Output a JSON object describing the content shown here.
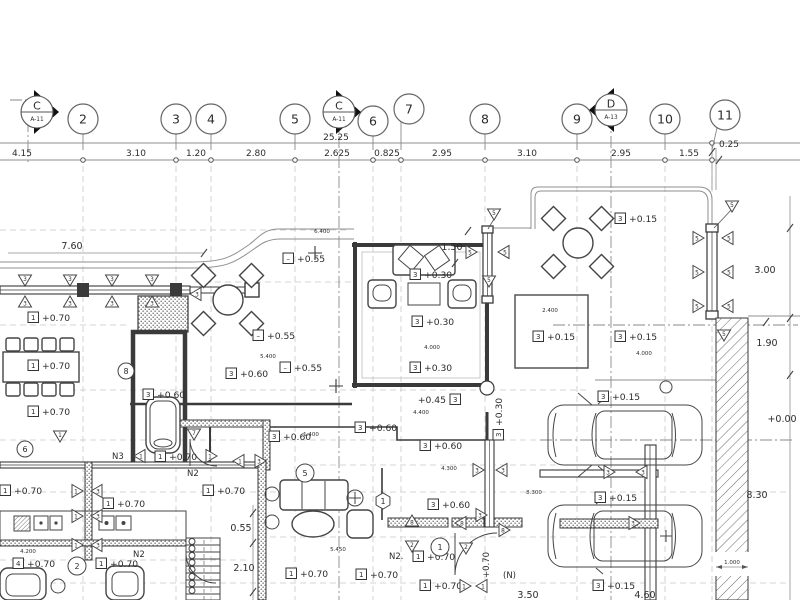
{
  "grid": {
    "bubbles": [
      {
        "n": "2",
        "x": 83,
        "y": 119,
        "gx": 83
      },
      {
        "n": "3",
        "x": 176,
        "y": 119,
        "gx": 176
      },
      {
        "n": "4",
        "x": 211,
        "y": 119,
        "gx": 211
      },
      {
        "n": "5",
        "x": 295,
        "y": 119,
        "gx": 295
      },
      {
        "n": "6",
        "x": 373,
        "y": 121,
        "gx": 373
      },
      {
        "n": "7",
        "x": 409,
        "y": 109,
        "gx": 401
      },
      {
        "n": "8",
        "x": 485,
        "y": 119,
        "gx": 485
      },
      {
        "n": "9",
        "x": 577,
        "y": 119,
        "gx": 577
      },
      {
        "n": "10",
        "x": 665,
        "y": 119,
        "gx": 665
      },
      {
        "n": "11",
        "x": 725,
        "y": 115,
        "gx": 712
      }
    ],
    "sections": [
      {
        "letter": "C",
        "sheet": "A-11",
        "x": 37,
        "y": 112,
        "dir": "right"
      },
      {
        "letter": "C",
        "sheet": "A-11",
        "x": 339,
        "y": 112,
        "dir": "right"
      },
      {
        "letter": "D",
        "sheet": "A-13",
        "x": 611,
        "y": 110,
        "dir": "left"
      }
    ],
    "total_dim": {
      "t": "25.25",
      "x": 336,
      "y": 140
    },
    "top_dims": [
      {
        "t": "4.15",
        "x": 22
      },
      {
        "t": "3.10",
        "x": 136
      },
      {
        "t": "1.20",
        "x": 196
      },
      {
        "t": "2.80",
        "x": 256
      },
      {
        "t": "2.625",
        "x": 337
      },
      {
        "t": "0.825",
        "x": 387
      },
      {
        "t": "2.95",
        "x": 442
      },
      {
        "t": "3.10",
        "x": 527
      },
      {
        "t": "2.95",
        "x": 621
      },
      {
        "t": "1.55",
        "x": 689
      },
      {
        "t": "0.25",
        "x": 729,
        "y": 147
      }
    ],
    "ticks": [
      83,
      176,
      211,
      295,
      373,
      401,
      485,
      577,
      665,
      712
    ]
  },
  "dims": [
    {
      "t": "7.60",
      "x": 72,
      "y": 249
    },
    {
      "t": "1.50",
      "x": 452,
      "y": 250
    },
    {
      "t": "3.00",
      "x": 765,
      "y": 273
    },
    {
      "t": "1.90",
      "x": 767,
      "y": 346
    },
    {
      "t": "+0.00",
      "x": 782,
      "y": 422
    },
    {
      "t": "8.30",
      "x": 757,
      "y": 498
    },
    {
      "t": "0.55",
      "x": 241,
      "y": 531
    },
    {
      "t": "2.10",
      "x": 244,
      "y": 571
    },
    {
      "t": "3.50",
      "x": 528,
      "y": 598
    },
    {
      "t": "4.60",
      "x": 645,
      "y": 598
    },
    {
      "t": "6.400",
      "x": 322,
      "y": 233,
      "fs": 5.5
    },
    {
      "t": "5.400",
      "x": 268,
      "y": 358,
      "fs": 5.5
    },
    {
      "t": "4.000",
      "x": 432,
      "y": 349,
      "fs": 5.5
    },
    {
      "t": "4.400",
      "x": 421,
      "y": 414,
      "fs": 5.5
    },
    {
      "t": "4.300",
      "x": 449,
      "y": 470,
      "fs": 5.5
    },
    {
      "t": "2.400",
      "x": 550,
      "y": 312,
      "fs": 5.5
    },
    {
      "t": "4.000",
      "x": 644,
      "y": 355,
      "fs": 5.5
    },
    {
      "t": "5.450",
      "x": 338,
      "y": 551,
      "fs": 5.5
    },
    {
      "t": "4.200",
      "x": 28,
      "y": 553,
      "fs": 5.5
    },
    {
      "t": "8.300",
      "x": 534,
      "y": 494,
      "fs": 5.5
    },
    {
      "t": "1.000",
      "x": 732,
      "y": 564,
      "fs": 5.5
    },
    {
      "t": "1.400",
      "x": 311,
      "y": 436,
      "fs": 5.5
    }
  ],
  "levels": [
    {
      "b": "1",
      "t": "+0.70",
      "x": 28,
      "y": 321
    },
    {
      "b": "1",
      "t": "+0.70",
      "x": 28,
      "y": 369
    },
    {
      "b": "1",
      "t": "+0.70",
      "x": 28,
      "y": 415
    },
    {
      "b": "1",
      "t": "+0.70",
      "x": 0,
      "y": 494
    },
    {
      "b": "1",
      "t": "+0.70",
      "x": 103,
      "y": 507
    },
    {
      "b": "1",
      "t": "+0.70",
      "x": 155,
      "y": 460
    },
    {
      "b": "1",
      "t": "+0.70",
      "x": 203,
      "y": 494
    },
    {
      "b": "4",
      "t": "+0.70",
      "x": 13,
      "y": 567
    },
    {
      "b": "1",
      "t": "+0.70",
      "x": 96,
      "y": 567
    },
    {
      "b": "1",
      "t": "+0.70",
      "x": 286,
      "y": 577
    },
    {
      "b": "1",
      "t": "+0.70",
      "x": 356,
      "y": 578
    },
    {
      "b": "1",
      "t": "+0.70",
      "x": 413,
      "y": 560
    },
    {
      "b": "1",
      "t": "+0.70",
      "x": 420,
      "y": 589
    },
    {
      "b": "3",
      "t": "+0.60",
      "x": 226,
      "y": 377
    },
    {
      "b": "3",
      "t": "+0.60",
      "x": 143,
      "y": 398
    },
    {
      "b": "3",
      "t": "+0.60",
      "x": 269,
      "y": 440
    },
    {
      "b": "3",
      "t": "+0.60",
      "x": 355,
      "y": 431
    },
    {
      "b": "3",
      "t": "+0.60",
      "x": 420,
      "y": 449
    },
    {
      "b": "3",
      "t": "+0.60",
      "x": 428,
      "y": 508
    },
    {
      "b": "3",
      "t": "+0.30",
      "x": 410,
      "y": 278
    },
    {
      "b": "3",
      "t": "+0.30",
      "x": 412,
      "y": 325
    },
    {
      "b": "3",
      "t": "+0.30",
      "x": 410,
      "y": 371
    },
    {
      "b": "3",
      "t": "+0.45",
      "x": 450,
      "y": 403,
      "flip": true
    },
    {
      "b": "3",
      "t": "+0.30",
      "x": 502,
      "y": 440,
      "rot": -90
    },
    {
      "b": "3",
      "t": "+0.15",
      "x": 615,
      "y": 222
    },
    {
      "b": "3",
      "t": "+0.15",
      "x": 533,
      "y": 340
    },
    {
      "b": "3",
      "t": "+0.15",
      "x": 615,
      "y": 340
    },
    {
      "b": "3",
      "t": "+0.15",
      "x": 598,
      "y": 400
    },
    {
      "b": "3",
      "t": "+0.15",
      "x": 595,
      "y": 501
    },
    {
      "b": "3",
      "t": "+0.15",
      "x": 593,
      "y": 589
    },
    {
      "b": "–",
      "t": "+0.55",
      "x": 283,
      "y": 262
    },
    {
      "b": "–",
      "t": "+0.55",
      "x": 253,
      "y": 339
    },
    {
      "b": "–",
      "t": "+0.55",
      "x": 280,
      "y": 371
    }
  ],
  "tags": {
    "circles": [
      {
        "t": "8",
        "x": 126,
        "y": 371,
        "r": 8
      },
      {
        "t": "6",
        "x": 25,
        "y": 449,
        "r": 8
      },
      {
        "t": "2",
        "x": 77,
        "y": 566,
        "r": 9
      },
      {
        "t": "5",
        "x": 305,
        "y": 473,
        "r": 9
      },
      {
        "t": "1",
        "x": 440,
        "y": 547,
        "r": 9
      }
    ],
    "hexes": [
      {
        "t": "1",
        "x": 383,
        "y": 501,
        "r": 8
      }
    ],
    "texts": [
      {
        "t": "N3",
        "x": 112,
        "y": 459
      },
      {
        "t": "N2",
        "x": 187,
        "y": 476
      },
      {
        "t": "N2",
        "x": 133,
        "y": 557
      },
      {
        "t": "N2.",
        "x": 389,
        "y": 559
      },
      {
        "t": "(N)",
        "x": 503,
        "y": 578
      },
      {
        "t": "+0.70",
        "x": 489,
        "y": 578,
        "rot": -90
      }
    ]
  },
  "markers": [
    {
      "t": "3",
      "x": 25,
      "y": 280,
      "d": "dn"
    },
    {
      "t": "3",
      "x": 25,
      "y": 302,
      "d": "up"
    },
    {
      "t": "3",
      "x": 70,
      "y": 280,
      "d": "dn"
    },
    {
      "t": "3",
      "x": 70,
      "y": 302,
      "d": "up"
    },
    {
      "t": "3",
      "x": 112,
      "y": 280,
      "d": "dn"
    },
    {
      "t": "3",
      "x": 112,
      "y": 302,
      "d": "up"
    },
    {
      "t": "3",
      "x": 152,
      "y": 280,
      "d": "dn"
    },
    {
      "t": "3",
      "x": 152,
      "y": 302,
      "d": "up"
    },
    {
      "t": "3",
      "x": 196,
      "y": 294,
      "d": "lf"
    },
    {
      "t": "5",
      "x": 471,
      "y": 252,
      "d": "rt"
    },
    {
      "t": "5",
      "x": 504,
      "y": 252,
      "d": "lf"
    },
    {
      "t": "5",
      "x": 489,
      "y": 281,
      "d": "dn"
    },
    {
      "t": "5",
      "x": 494,
      "y": 214,
      "d": "dn"
    },
    {
      "t": "5",
      "x": 698,
      "y": 238,
      "d": "rt"
    },
    {
      "t": "5",
      "x": 728,
      "y": 238,
      "d": "lf"
    },
    {
      "t": "5",
      "x": 698,
      "y": 272,
      "d": "rt"
    },
    {
      "t": "5",
      "x": 728,
      "y": 272,
      "d": "lf"
    },
    {
      "t": "5",
      "x": 698,
      "y": 306,
      "d": "rt"
    },
    {
      "t": "5",
      "x": 728,
      "y": 306,
      "d": "lf"
    },
    {
      "t": "5",
      "x": 732,
      "y": 206,
      "d": "dn"
    },
    {
      "t": "5",
      "x": 724,
      "y": 335,
      "d": "dn"
    },
    {
      "t": "1",
      "x": 77,
      "y": 491,
      "d": "rt"
    },
    {
      "t": "3",
      "x": 97,
      "y": 491,
      "d": "lf"
    },
    {
      "t": "1",
      "x": 77,
      "y": 516,
      "d": "rt"
    },
    {
      "t": "3",
      "x": 97,
      "y": 516,
      "d": "lf"
    },
    {
      "t": "1",
      "x": 77,
      "y": 545,
      "d": "rt"
    },
    {
      "t": "3",
      "x": 97,
      "y": 545,
      "d": "lf"
    },
    {
      "t": "1",
      "x": 239,
      "y": 461,
      "d": "lf"
    },
    {
      "t": "3",
      "x": 260,
      "y": 461,
      "d": "rt"
    },
    {
      "t": "1",
      "x": 140,
      "y": 456,
      "d": "lf"
    },
    {
      "t": "1",
      "x": 211,
      "y": 456,
      "d": "rt"
    },
    {
      "t": "3",
      "x": 609,
      "y": 472,
      "d": "rt"
    },
    {
      "t": "3",
      "x": 642,
      "y": 472,
      "d": "lf"
    },
    {
      "t": "8",
      "x": 412,
      "y": 521,
      "d": "up"
    },
    {
      "t": "2",
      "x": 412,
      "y": 546,
      "d": "dn"
    },
    {
      "t": "8",
      "x": 461,
      "y": 523,
      "d": "lf"
    },
    {
      "t": "3",
      "x": 481,
      "y": 515,
      "d": "rt"
    },
    {
      "t": "2",
      "x": 466,
      "y": 548,
      "d": "dn"
    },
    {
      "t": "8",
      "x": 504,
      "y": 530,
      "d": "rt"
    },
    {
      "t": "3",
      "x": 478,
      "y": 470,
      "d": "rt"
    },
    {
      "t": "3",
      "x": 502,
      "y": 470,
      "d": "lf"
    },
    {
      "t": "1",
      "x": 60,
      "y": 436,
      "d": "dn"
    },
    {
      "t": "7",
      "x": 194,
      "y": 434,
      "d": "dn"
    },
    {
      "t": "1",
      "x": 465,
      "y": 586,
      "d": "rt"
    },
    {
      "t": "1",
      "x": 482,
      "y": 586,
      "d": "lf"
    },
    {
      "t": "3",
      "x": 634,
      "y": 523,
      "d": "rt"
    }
  ],
  "slashes": [
    {
      "x": 204,
      "y": 253
    },
    {
      "x": 719,
      "y": 160
    },
    {
      "x": 712,
      "y": 152
    },
    {
      "x": 790,
      "y": 228
    },
    {
      "x": 790,
      "y": 318
    },
    {
      "x": 790,
      "y": 375
    },
    {
      "x": 253,
      "y": 513
    },
    {
      "x": 253,
      "y": 543
    },
    {
      "x": 253,
      "y": 592
    },
    {
      "x": 468,
      "y": 231
    },
    {
      "x": 455,
      "y": 263
    },
    {
      "x": 766,
      "y": 322
    }
  ]
}
